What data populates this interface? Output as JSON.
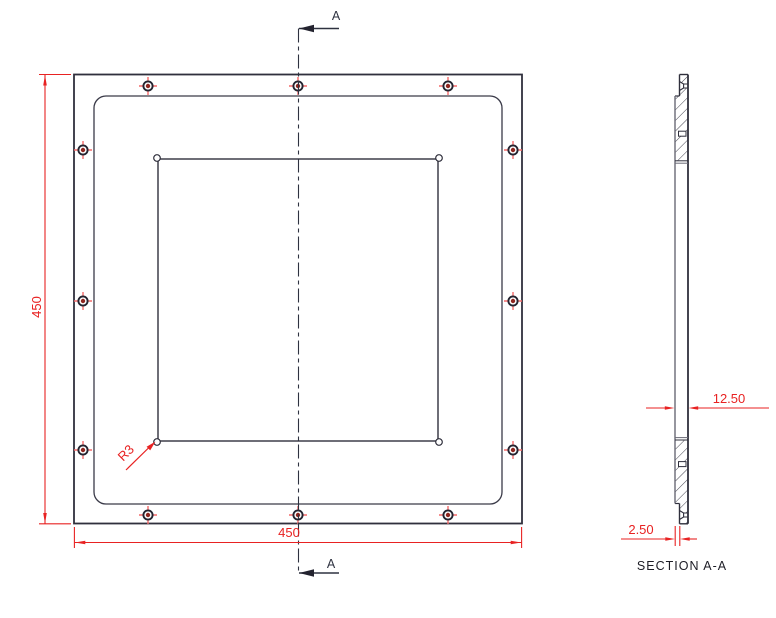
{
  "drawing": {
    "front_view": {
      "dimension_height": "450",
      "dimension_width": "450",
      "fillet_radius_label": "R3",
      "section_cut_label_top": "A",
      "section_cut_label_bottom": "A"
    },
    "section_view": {
      "caption": "SECTION A-A",
      "dimension_thickness": "12.50",
      "dimension_step": "2.50"
    },
    "colors": {
      "outline": "#30303d",
      "secondary_edge": "#6a6a76",
      "dimension_red": "#e82222",
      "hole_crosshair_red": "#f46a6a",
      "hole_center_dot": "#8f2620",
      "background": "#ffffff"
    }
  }
}
